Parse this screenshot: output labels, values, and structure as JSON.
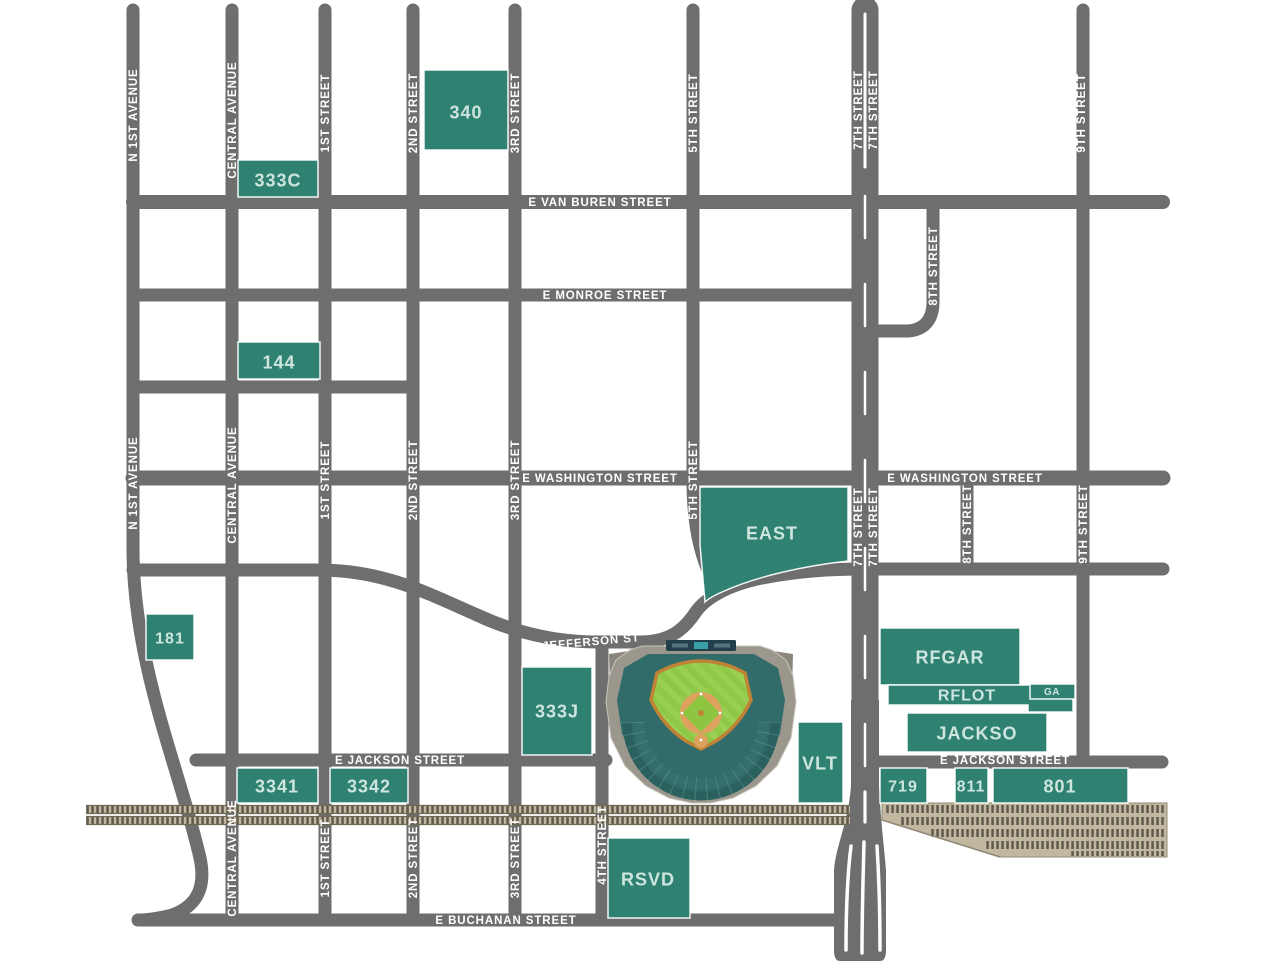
{
  "map": {
    "title": "Chase Field area parking map",
    "streets": {
      "n_1st_avenue": "N 1ST AVENUE",
      "central_avenue": "CENTRAL AVENUE",
      "street_1st": "1ST STREET",
      "street_2nd": "2ND STREET",
      "street_3rd": "3RD STREET",
      "street_4th": "4TH STREET",
      "street_5th": "5TH STREET",
      "street_7th": "7TH STREET",
      "street_8th": "8TH STREET",
      "street_9th": "9TH STREET",
      "van_buren": "E VAN BUREN STREET",
      "monroe": "E MONROE STREET",
      "washington": "E WASHINGTON STREET",
      "jefferson": "E JEFFERSON ST",
      "jackson": "E JACKSON STREET",
      "buchanan": "E BUCHANAN STREET"
    },
    "lots": {
      "l340": "340",
      "l333c": "333C",
      "l144": "144",
      "l181": "181",
      "east": "EAST",
      "l333j": "333J",
      "vlt": "VLT",
      "rfgar": "RFGAR",
      "rflot": "RFLOT",
      "ga": "GA",
      "jackso": "JACKSO",
      "l719": "719",
      "l811": "811",
      "l801": "801",
      "l3341": "3341",
      "l3342": "3342",
      "rsvd": "RSVD"
    },
    "colors": {
      "street": "#6E6E6E",
      "casing": "#FFFFFF",
      "lot": "#2F8172",
      "lot_text": "#CDE5DD",
      "street_text": "#FFFFFF",
      "rail_base": "#C1B89F",
      "rail_tie": "#3E3A31",
      "field_green": "#8DC541",
      "field_dirt": "#DCA25E",
      "stadium_concrete": "#9C978D",
      "stadium_seats": "#316C6B"
    }
  }
}
